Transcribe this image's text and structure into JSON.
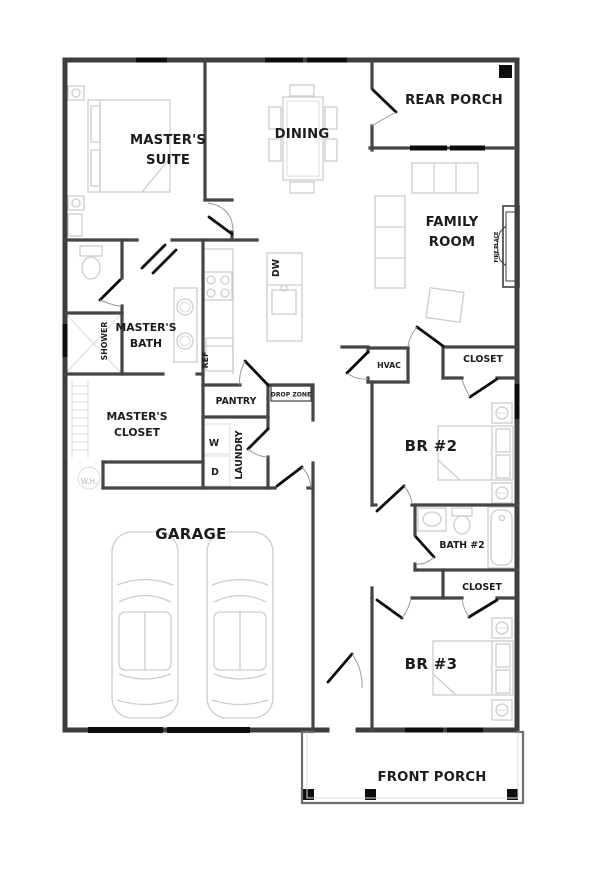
{
  "plan": {
    "rooms": {
      "master_suite": {
        "line1": "MASTER'S",
        "line2": "SUITE"
      },
      "dining": {
        "label": "DINING"
      },
      "rear_porch": {
        "label": "REAR PORCH"
      },
      "family_room": {
        "line1": "FAMILY",
        "line2": "ROOM"
      },
      "master_bath": {
        "line1": "MASTER'S",
        "line2": "BATH"
      },
      "shower": {
        "label": "SHOWER"
      },
      "master_closet": {
        "line1": "MASTER'S",
        "line2": "CLOSET"
      },
      "pantry": {
        "label": "PANTRY"
      },
      "drop_zone": {
        "label": "DROP ZONE"
      },
      "laundry": {
        "label": "LAUNDRY"
      },
      "washer": {
        "label": "W"
      },
      "dryer": {
        "label": "D"
      },
      "hvac": {
        "label": "HVAC"
      },
      "closet_br2": {
        "label": "CLOSET"
      },
      "br2": {
        "label": "BR #2"
      },
      "bath2": {
        "label": "BATH #2"
      },
      "closet_br3": {
        "label": "CLOSET"
      },
      "br3": {
        "label": "BR #3"
      },
      "garage": {
        "label": "GARAGE"
      },
      "front_porch": {
        "label": "FRONT PORCH"
      }
    },
    "fixtures": {
      "water_heater": {
        "label": "W.H."
      },
      "fireplace": {
        "label": "FIRE PLACE"
      },
      "dishwasher": {
        "label": "DW"
      },
      "refrigerator": {
        "label": "REF"
      }
    },
    "colors": {
      "wall": "#3e3e3e",
      "window_and_door": "#0d0d0d",
      "furniture_outline": "#cdcdcd",
      "label_text": "#1c1c1c",
      "muted_text": "#b8b8b8",
      "background": "#ffffff"
    }
  }
}
